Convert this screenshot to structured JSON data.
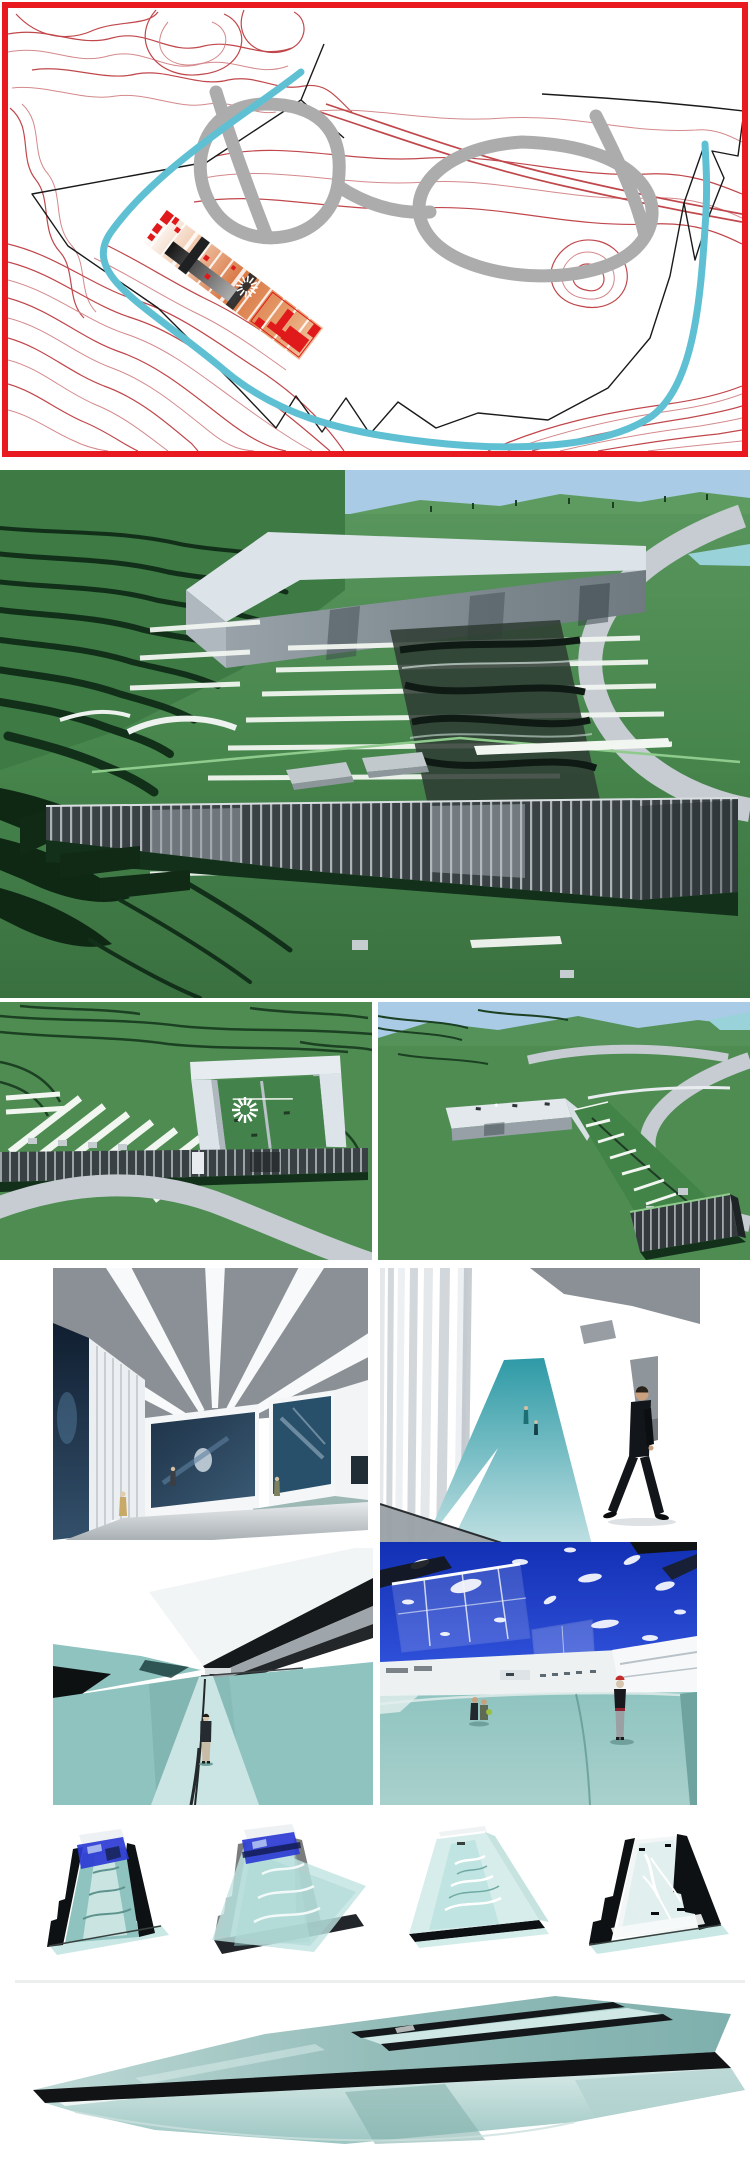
{
  "page": {
    "background": "#FFFFFF"
  },
  "palette": {
    "frame_red": "#E8191F",
    "contour_red": "#C0474B",
    "boundary_black": "#1A1A1A",
    "loop_gray": "#ACACAC",
    "route_cyan": "#5FC0D3",
    "plan_red": "#E01A1A",
    "plan_orange": "#D97845",
    "sky_blue": "#A9CBE6",
    "grass_green": "#4E8C52",
    "terrace_shadow": "#123019",
    "building_white": "#DCE4EA",
    "building_gray": "#9AA4AB",
    "louver_dark": "#3A4145",
    "road_gray": "#C6CCD1",
    "stripe_white": "#F2F6F1",
    "ceiling_gray": "#8A9095",
    "mural_navy": "#16283C",
    "bench_teal": "#9DB8B5",
    "canal_teal": "#8FC3BF",
    "canal_path": "#CBE4E4",
    "deep_sky_blue": "#2040C8",
    "glass_teal": "#BFE4E1",
    "section_black": "#0E1113",
    "suit_black": "#121519",
    "skin_tan": "#C9A17E",
    "cap_red": "#C42B2B"
  },
  "panels": {
    "site_plan": {
      "label": "Red-framed site plan: topographic contour lines, black site boundary, gray figure-eight circulation loop, cyan route and rotated red-orange building footprint with radial sun motif"
    },
    "hero_render": {
      "label": "Large aerial rendering: terraced green hillside, L-shaped white roof slab over glass courtyard, striped green roof field, curved gray road, long louvered facade"
    },
    "aerial_left": {
      "label": "Aerial rendering: U-shaped white building on striped green roof with radial sun motif, louvered facade band and curved road in foreground"
    },
    "aerial_right": {
      "label": "Aerial rendering: angled white building with green roof strip descending to louvered volume, curved roads, sky and pond on horizon"
    },
    "gallery_interior": {
      "label": "Gallery interior: gray ceiling with radial white skylight beams, navy mural wall, artwork walls, teal bench band and three visitors"
    },
    "corridor_interior": {
      "label": "Interior view: vertical louver wall, teal ramp descending with small figures, man in black suit walking on white floor"
    },
    "canal_white": {
      "label": "Canal walk rendering: dark angular canopy over teal valley floor with central light path and standing figure, white sky"
    },
    "canal_blue": {
      "label": "Canal plaza rendering: deep blue sky with clouds, translucent glass canopies, white pavilions, teal bowl floor with seated couple and standing girl"
    },
    "sections": {
      "label": "Four sectional axonometric study wedges",
      "items": [
        {
          "label": "Section wedge with black terraced sides, teal channel and blue glass canopy"
        },
        {
          "label": "Section wedge overlaid with translucent teal glass sheet and blue canopy"
        },
        {
          "label": "Section wedge as pale teal glass shell with wave lines"
        },
        {
          "label": "Section wedge with black terraced sides and branching white channel, roof removed"
        }
      ]
    },
    "glass_wedge": {
      "label": "Thin triangular glass roof plane with black edge band and dark slot openings hovering over lower teal plane"
    }
  }
}
